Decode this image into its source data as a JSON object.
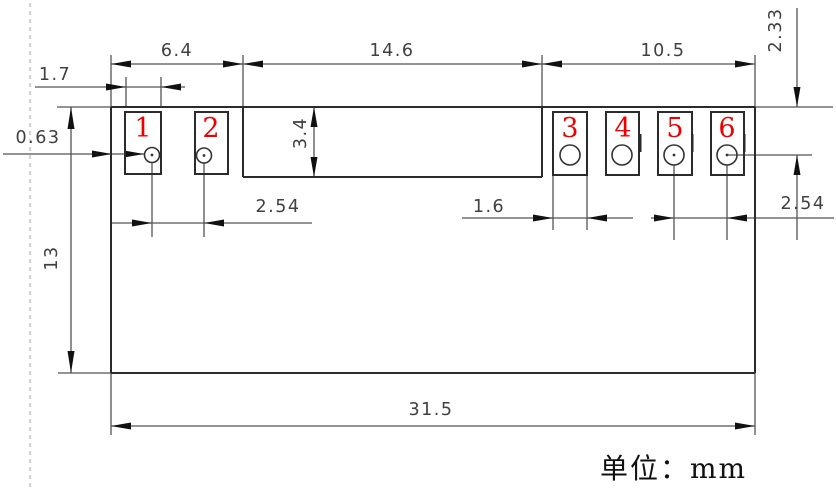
{
  "unit_label": "单位：mm",
  "dimensions": {
    "left_group_width": "6.4",
    "center_width": "14.6",
    "right_group_width": "10.5",
    "pad1_width": "1.7",
    "edge_to_pad1": "0.63",
    "top_to_hole": "2.33",
    "center_height": "3.4",
    "body_height": "13",
    "left_pitch": "2.54",
    "pad3_width": "1.6",
    "right_pitch": "2.54",
    "total_width": "31.5"
  },
  "pads": [
    {
      "label": "1"
    },
    {
      "label": "2"
    },
    {
      "label": "3"
    },
    {
      "label": "4"
    },
    {
      "label": "5"
    },
    {
      "label": "6"
    }
  ],
  "colors": {
    "outline": "#2b2b2b",
    "dim-line": "#555555",
    "dim-text": "#404040",
    "arrow": "#111111",
    "pad-number": "#ee0000",
    "centerline": "#b5b5b5",
    "unit-text": "#111111",
    "background": "#ffffff"
  }
}
